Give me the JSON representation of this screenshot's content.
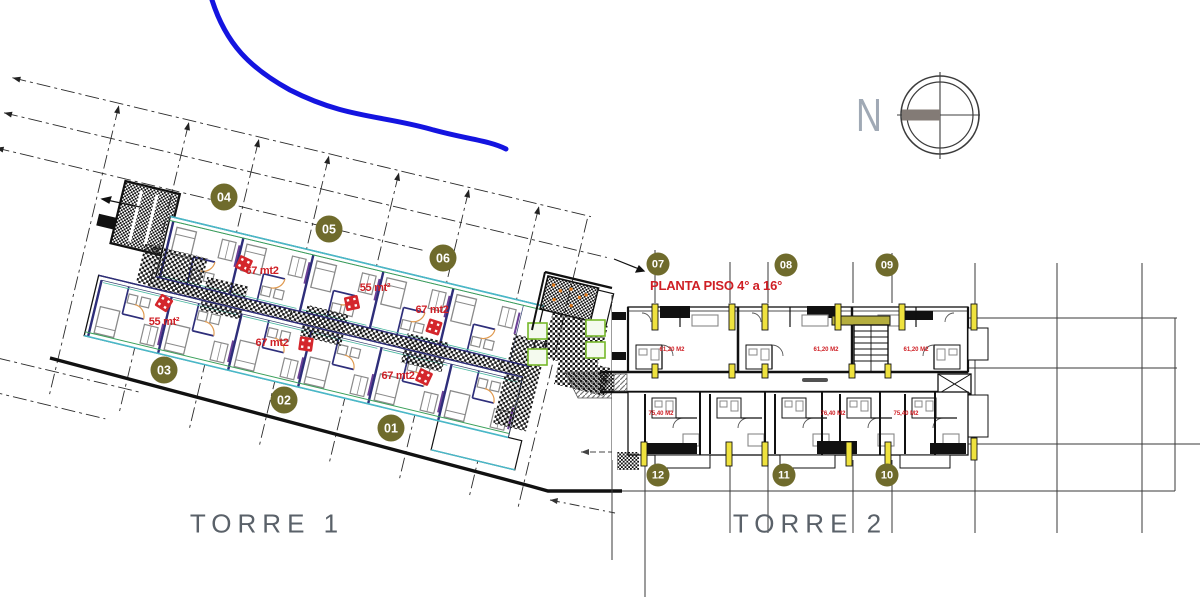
{
  "plan_title": {
    "text": "PLANTA PISO 4° a 16°",
    "color": "#cf1f25"
  },
  "compass": {
    "label": "N"
  },
  "towers": [
    {
      "label": "TORRE 1"
    },
    {
      "label": "TORRE 2"
    }
  ],
  "unit_badges": [
    {
      "number": "01",
      "x": 391,
      "y": 428
    },
    {
      "number": "02",
      "x": 284,
      "y": 400
    },
    {
      "number": "03",
      "x": 164,
      "y": 370
    },
    {
      "number": "04",
      "x": 224,
      "y": 197
    },
    {
      "number": "05",
      "x": 329,
      "y": 229
    },
    {
      "number": "06",
      "x": 443,
      "y": 258
    },
    {
      "number": "07",
      "x": 658,
      "y": 264
    },
    {
      "number": "08",
      "x": 786,
      "y": 265
    },
    {
      "number": "09",
      "x": 887,
      "y": 265
    },
    {
      "number": "10",
      "x": 887,
      "y": 475
    },
    {
      "number": "11",
      "x": 784,
      "y": 475
    },
    {
      "number": "12",
      "x": 658,
      "y": 475
    }
  ],
  "area_labels_torre1": [
    {
      "text": "67 mt2",
      "x": 262,
      "y": 271
    },
    {
      "text": "55 mt²",
      "x": 375,
      "y": 288
    },
    {
      "text": "67 mt2",
      "x": 432,
      "y": 310
    },
    {
      "text": "55 mt²",
      "x": 164,
      "y": 322
    },
    {
      "text": "67 mt2",
      "x": 272,
      "y": 343
    },
    {
      "text": "67 mt2",
      "x": 398,
      "y": 376
    }
  ],
  "area_labels_torre2": [
    {
      "text": "61,20 M2",
      "x": 672,
      "y": 350
    },
    {
      "text": "61,20 M2",
      "x": 826,
      "y": 350
    },
    {
      "text": "61,20 M2",
      "x": 916,
      "y": 350
    },
    {
      "text": "75,40 M2",
      "x": 661,
      "y": 414
    },
    {
      "text": "76,40 M2",
      "x": 833,
      "y": 414
    },
    {
      "text": "75,40 M2",
      "x": 906,
      "y": 414
    }
  ],
  "colors": {
    "badge": "#6f6b2c",
    "area_label": "#cf1f25",
    "road": "#1414e0",
    "torre_label": "#5a6169",
    "column_yellow": "#efe23e",
    "stair_bar_olive": "#b5ae3f",
    "elevator_green": "#76b82a",
    "door_arc_orange": "#e09a50",
    "wall_navy": "#2e2e7a"
  }
}
